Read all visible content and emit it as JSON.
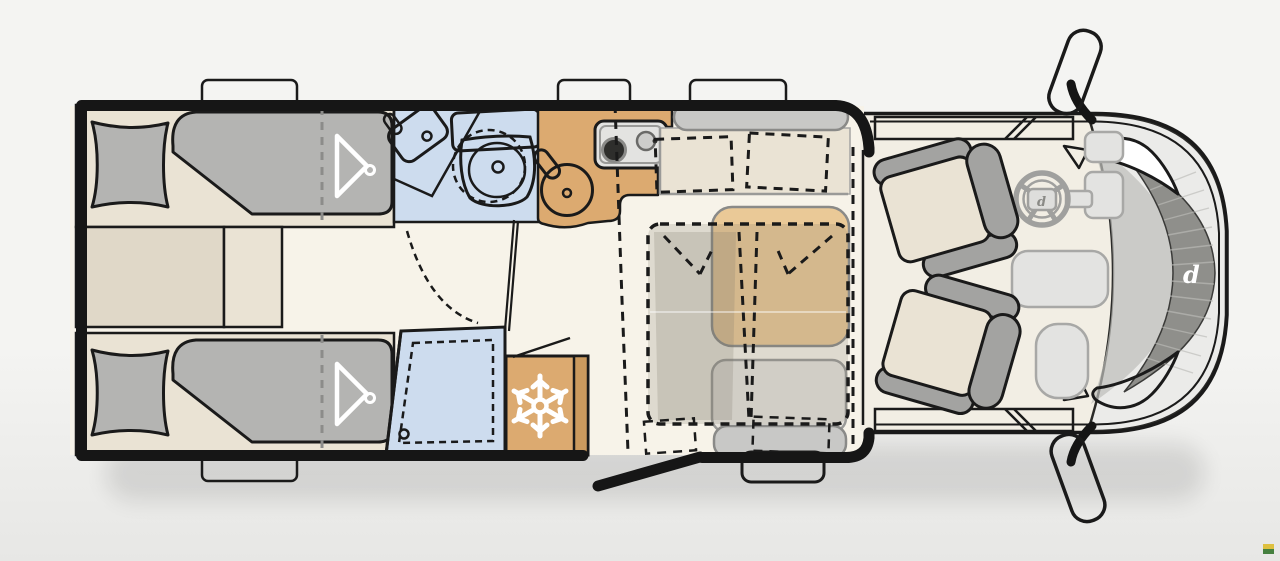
{
  "brand": {
    "windshield_logo_letter": "d",
    "steering_logo_letter": "d"
  },
  "icons": {
    "freezer": "snowflake-icon",
    "wardrobe_top_bed": "clothes-hanger-icon",
    "wardrobe_bottom_bed": "clothes-hanger-icon",
    "mirrors": "side-mirror-icon"
  },
  "colors": {
    "bg": "#f4f4f2",
    "bg2": "#e7e7e5",
    "line": "#1a1a1a",
    "wall": "#161616",
    "floor": "#f7f3e9",
    "beige": "#eae3d4",
    "beigeMid": "#e0d8c8",
    "softgray": "#b4b4b2",
    "blue": "#cddcee",
    "tan": "#dcaa70",
    "tanDark": "#cb9a5e",
    "table": "#eac997",
    "bench": "#c8c8c6",
    "seatgray": "#a3a3a1",
    "stove": "#e3e3e1",
    "cabbody": "#ebebe9",
    "cabfloor": "#f2eee4",
    "dashpanel": "#e3e3e1",
    "windshield": "#8f8f8b",
    "graystroke": "#9a9a98",
    "white": "#ffffff",
    "overlay": "rgba(125,118,106,0.20)",
    "watermark_yellow": "#dec03f",
    "watermark_green": "#45803f"
  }
}
